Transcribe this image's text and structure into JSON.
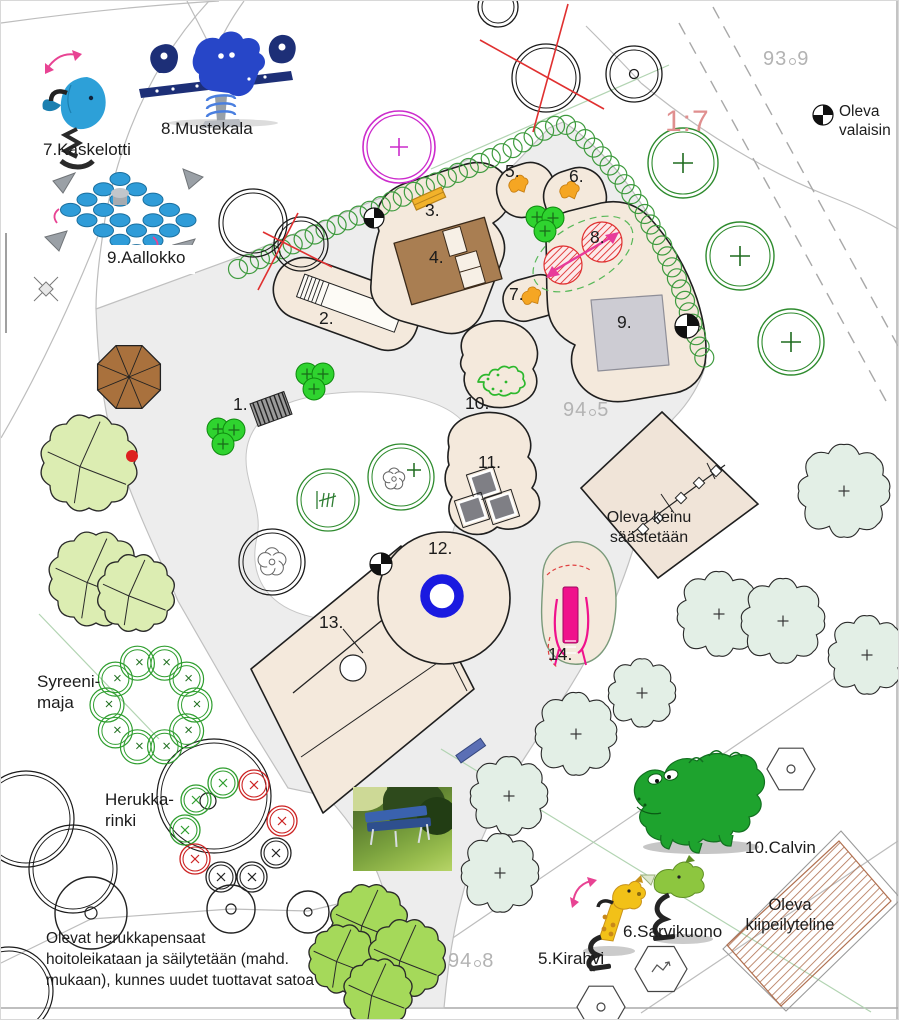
{
  "plan": {
    "area_labels": [
      "1.",
      "2.",
      "3.",
      "4.",
      "5.",
      "6.",
      "7.",
      "8.",
      "9.",
      "10.",
      "11.",
      "12.",
      "13.",
      "14."
    ],
    "elevations": [
      {
        "whole": "93",
        "dec": "9"
      },
      {
        "whole": "94",
        "dec": "5"
      },
      {
        "whole": "94",
        "dec": "8"
      }
    ],
    "slope_label": "1:7"
  },
  "equipment_labels": {
    "kaskelotti": "7.Kaskelotti",
    "mustekala": "8.Mustekala",
    "aallokko": "9.Aallokko",
    "kirahvi": "5.Kirahvi",
    "sarvikuono": "6.Sarvikuono",
    "calvin": "10.Calvin"
  },
  "annotations": {
    "oleva_valaisin": "Oleva valaisin",
    "oleva_keinu_line1": "Oleva keinu",
    "oleva_keinu_line2": "säästetään",
    "syreeni_maja": "Syreeni-maja",
    "herukka_rinki": "Herukka-rinki",
    "shrub_note_line1": "Olevat herukkapensaat",
    "shrub_note_line2": "hoitoleikataan ja säilytetään (mahd.",
    "shrub_note_line3": "mukaan), kunnes uudet tuottavat satoa",
    "kiipeilyteline_line1": "Oleva",
    "kiipeilyteline_line2": "kiipeilyteline"
  },
  "colors": {
    "surface_beige": "#f4e9dc",
    "path_gray": "#ededed",
    "building_brown": "#a97e52",
    "fence_green": "#3f9b3f",
    "new_tree_green": "#2e8b2e",
    "accent_magenta": "#cc2bcc",
    "removal_red": "#e03030",
    "equipment_pink": "#f0128c",
    "carousel_blue": "#1a1ae0",
    "slope_pink": "#e08f8f",
    "elevation_gray": "#b3b3b3"
  }
}
